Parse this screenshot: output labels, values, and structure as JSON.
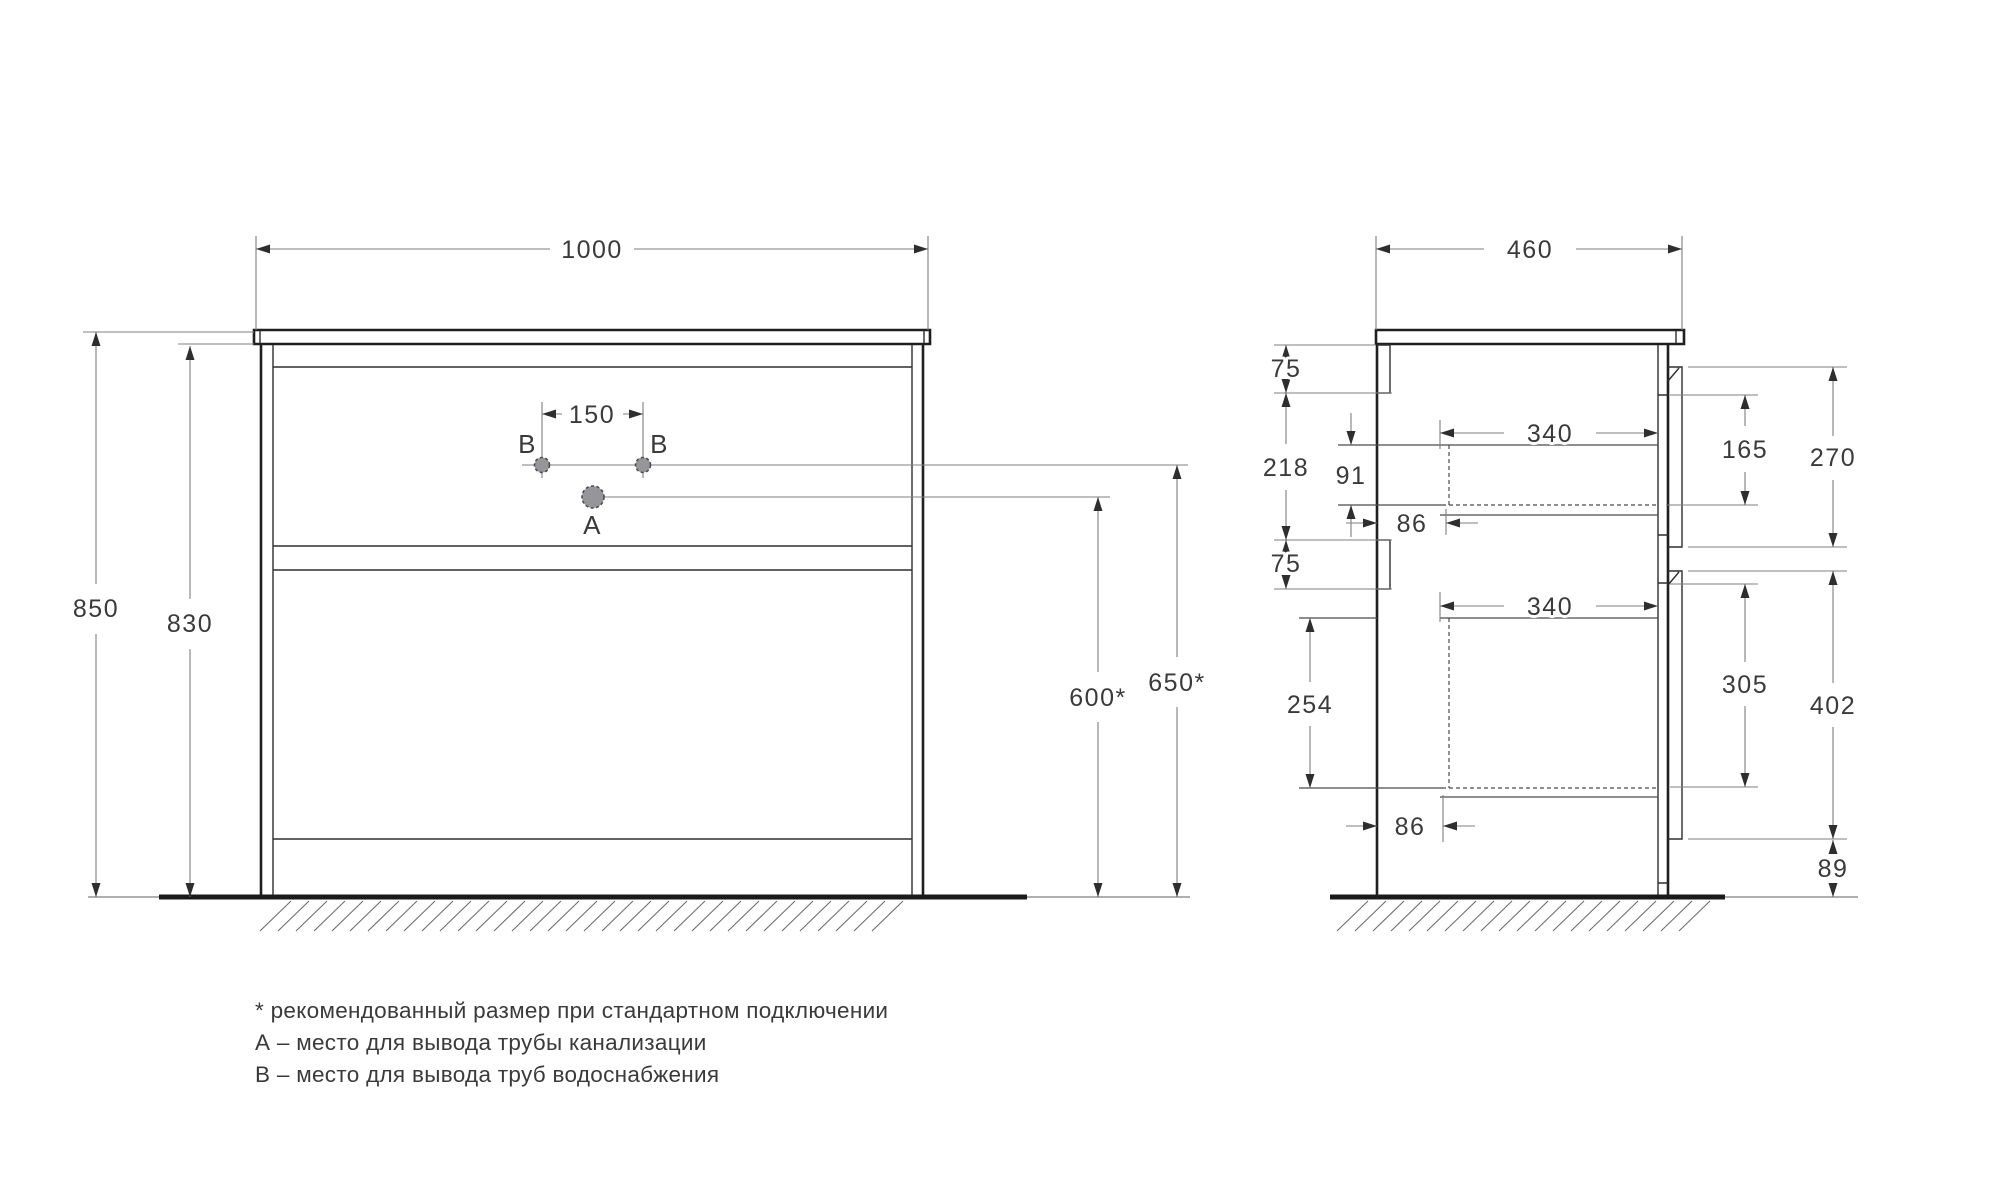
{
  "drawing_title": "vanity-cabinet-installation-dimensions",
  "colors": {
    "cabinet_line": "#1f1f1f",
    "detail_line": "#3a3a3a",
    "dimension_line": "#7f7f7f",
    "arrow": "#2e2e2e",
    "text": "#3a3a3a",
    "ground": "#1a1a1a",
    "hatch": "#6e6e6e",
    "point_fill": "#96969a",
    "point_stroke": "#4c4c4c"
  },
  "front_view": {
    "width": "1000",
    "overall_height": "850",
    "body_height": "830",
    "outlet_spacing": "150",
    "drain_outlet_height": "600*",
    "supply_outlet_height": "650*",
    "point_a_label": "A",
    "point_b_label": "B"
  },
  "side_view": {
    "depth": "460",
    "top_bracket": "75",
    "upper_span": "218",
    "mid_bracket": "75",
    "top_drawer_inner_height": "91",
    "top_back_offset": "86",
    "top_drawer_depth": "340",
    "top_front_span": "165",
    "top_drawer_front_height": "270",
    "bottom_drawer_inner_height": "254",
    "bottom_back_offset": "86",
    "bottom_drawer_depth": "340",
    "bottom_front_span": "305",
    "bottom_drawer_front_height": "402",
    "plinth_gap": "89"
  },
  "legend": {
    "note": "* рекомендованный размер при стандартном подключении",
    "point_a": "А – место для вывода трубы канализации",
    "point_b": "В – место для вывода труб водоснабжения"
  }
}
